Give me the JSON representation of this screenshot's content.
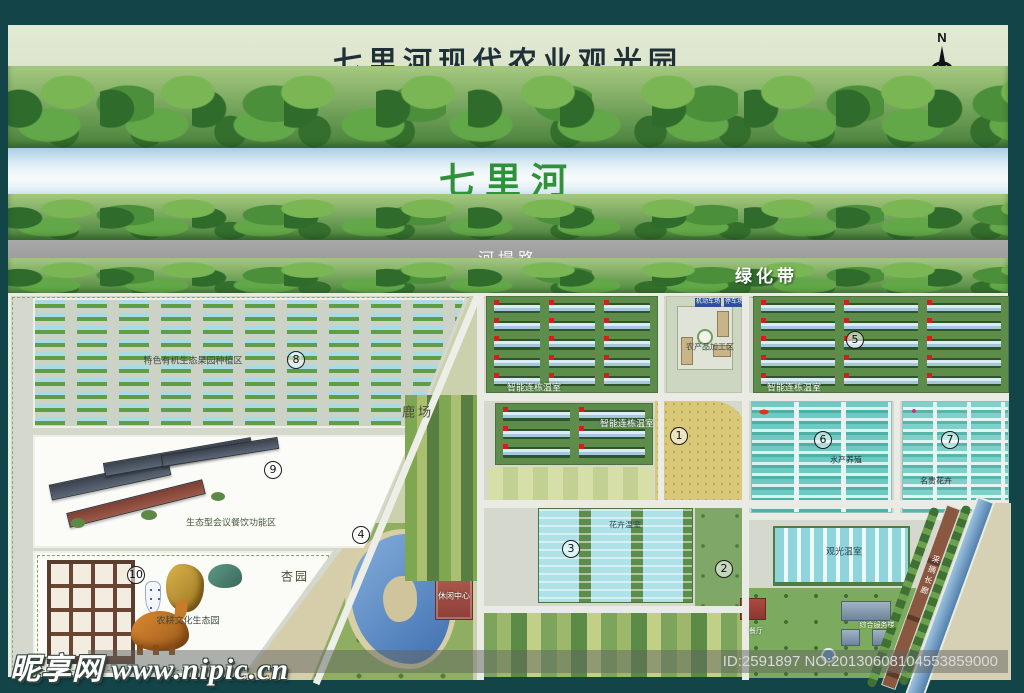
{
  "header": {
    "title": "七里河现代农业观光园",
    "compass": "N"
  },
  "bands": {
    "river": "七里河",
    "road": "河堤路",
    "greenbelt": "绿化带"
  },
  "zone_numbers": [
    "1",
    "2",
    "3",
    "4",
    "5",
    "6",
    "7",
    "8",
    "9",
    "10"
  ],
  "labels": {
    "orchard": "特色有机生态果园种植区",
    "dining": "生态型会议餐饮功能区",
    "culture": "农耕文化生态园",
    "deer": "鹿场",
    "apricot": "杏园",
    "smart_greenhouse": "智能连栋温室",
    "processing": "农产品加工区",
    "parking_a": "机动车场",
    "parking_b": "停车场",
    "aquaculture": "水产养殖",
    "rare_flowers": "名贵花卉",
    "flower_greenhouse": "花卉温室",
    "sightseeing": "观光温室",
    "leisure": "休闲中心",
    "restaurant": "餐厅",
    "service": "综合服务楼",
    "corridor": "采摘长廊"
  },
  "watermark": {
    "site": "昵享网 www.nipic.cn",
    "serial": "ID:2591897 NO:20130608104553859000"
  }
}
